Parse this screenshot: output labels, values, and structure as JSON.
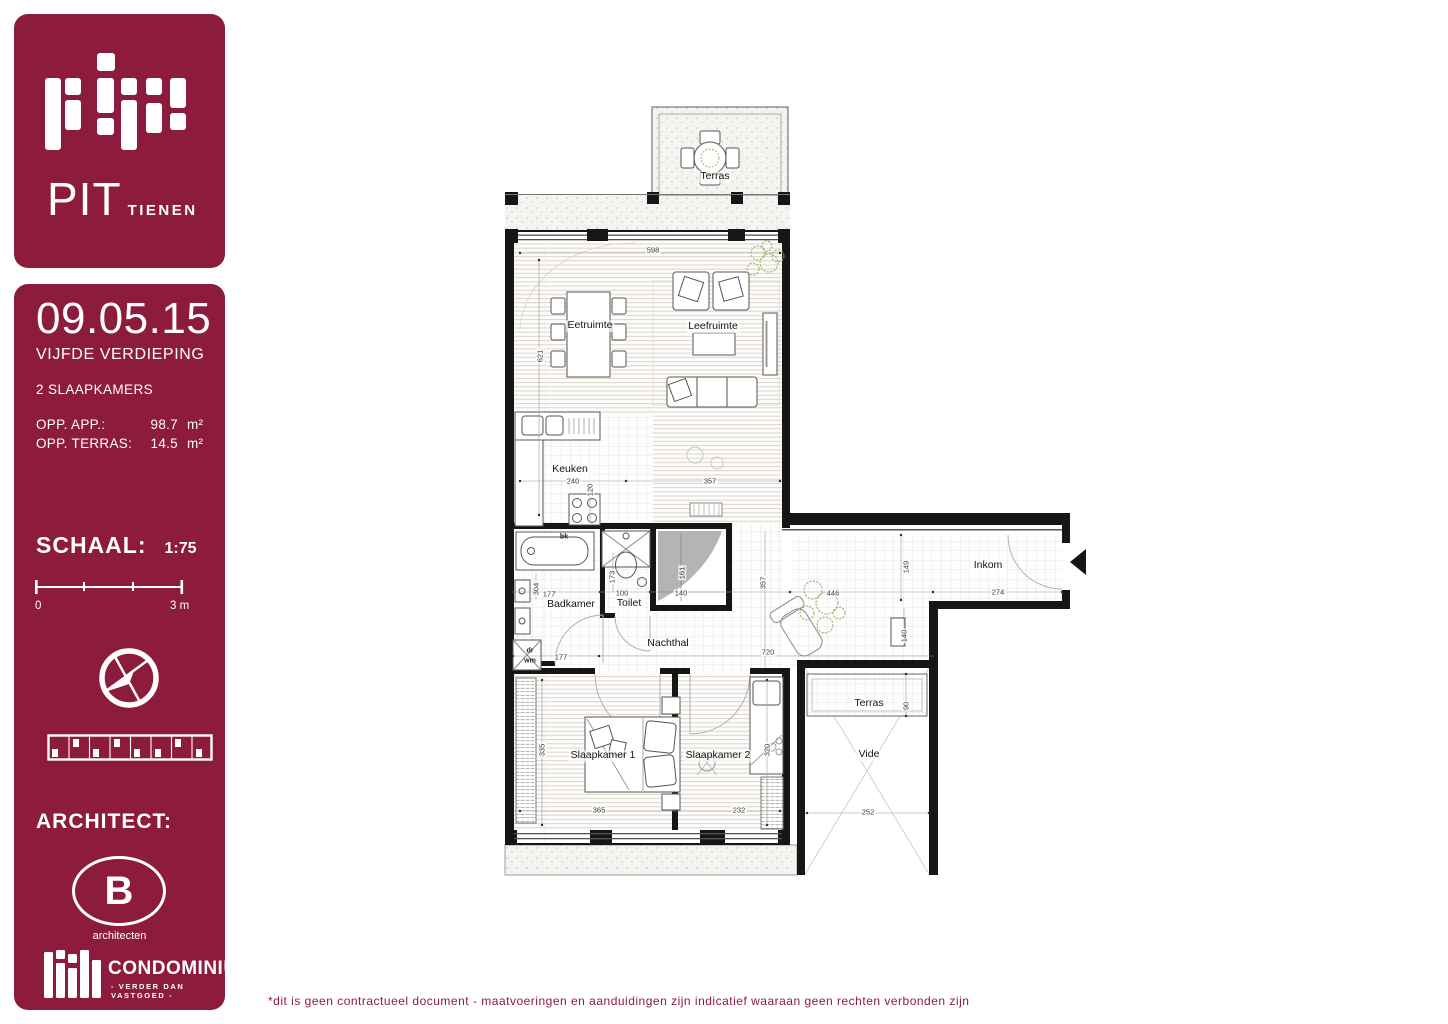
{
  "colors": {
    "brand": "#8d1b3d"
  },
  "logo_panel": {
    "title": "PIT",
    "subtitle": "TIENEN"
  },
  "info_panel": {
    "date": "09.05.15",
    "floor": "VIJFDE VERDIEPING",
    "apartment_type": "2 SLAAPKAMERS",
    "areas": [
      {
        "label": "OPP. APP.:",
        "value": "98.7",
        "unit": "m²"
      },
      {
        "label": "OPP. TERRAS:",
        "value": "14.5",
        "unit": "m²"
      }
    ],
    "scale_label": "SCHAAL:",
    "scale_value": "1:75",
    "scalebar": {
      "start": "0",
      "end": "3 m"
    },
    "architect_label": "ARCHITECT:",
    "architect_initial": "B",
    "architect_name": "architecten",
    "brand_name": "CONDOMINIUM",
    "brand_tagline": "- VERDER DAN VASTGOED -"
  },
  "plan": {
    "rooms": [
      "Terras",
      "Eetruimte",
      "Leefruimte",
      "Keuken",
      "Badkamer",
      "Toilet",
      "Nachthal",
      "Inkom",
      "Slaapkamer 1",
      "Slaapkamer 2",
      "Terras",
      "Vide"
    ],
    "dims": [
      "598",
      "621",
      "240",
      "120",
      "357",
      "161",
      "140",
      "177",
      "304",
      "100",
      "173",
      "357",
      "177",
      "720",
      "446",
      "149",
      "274",
      "140",
      "365",
      "232",
      "335",
      "320",
      "90",
      "252"
    ],
    "appliances": [
      "bk",
      "dr",
      "wm"
    ]
  },
  "footer": {
    "disclaimer": "*dit is geen contractueel document - maatvoeringen en aanduidingen zijn indicatief waaraan geen rechten verbonden zijn"
  }
}
